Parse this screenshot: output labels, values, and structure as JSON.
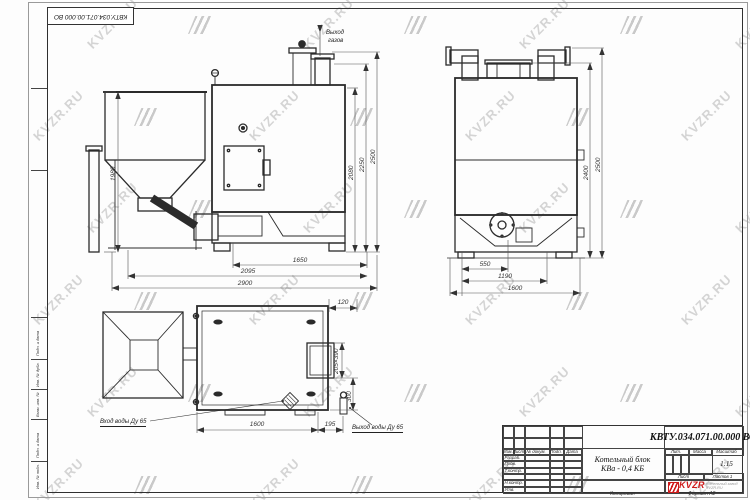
{
  "watermark": {
    "text": "KVZR.RU"
  },
  "frame": {
    "corner_stamp": "КВТУ.034.071.00.000 ВО",
    "margin_labels": [
      "Подп. и дата",
      "Инв. № дубл.",
      "Взам. инв. №",
      "Подп. и дата",
      "Инв. № подл."
    ],
    "copied_label": "Копировал",
    "format_label": "Формат А2"
  },
  "labels": {
    "gas_out_line1": "Выход",
    "gas_out_line2": "газов",
    "water_in": "Вход воды Ду 65",
    "water_out": "Выход воды Ду 65"
  },
  "dims": {
    "front_hopper_height": "1980",
    "front_h1": "2080",
    "front_h2": "2250",
    "front_h3": "2500",
    "front_w1": "1650",
    "front_w2": "2095",
    "front_w3": "2900",
    "side_h1": "2400",
    "side_h2": "2500",
    "side_w1": "550",
    "side_w2": "1190",
    "side_w3": "1600",
    "plan_offset": "120",
    "plan_window": "205×390",
    "plan_depth": "300",
    "plan_w1": "1600",
    "plan_w2": "195"
  },
  "title_block": {
    "doc_number": "КВТУ.034.071.00.000 ВО",
    "name_line1": "Котельный блок",
    "name_line2": "КВа - 0,4 КБ",
    "header_cols": [
      "Изм.",
      "Лист",
      "№ докум.",
      "Подп.",
      "Дата"
    ],
    "rows": [
      "Разраб.",
      "Пров.",
      "Т.контр.",
      "Н.контр.",
      "Утв."
    ],
    "lit_label": "Лит.",
    "mass_label": "Масса",
    "scale_label": "Масштаб",
    "scale_value": "1:15",
    "sheet_label": "Лист",
    "sheets_label": "Листов 1",
    "logo_text": "KVZR",
    "org_line1": "Котельный завод",
    "org_line2": "KVZR.RU"
  },
  "colors": {
    "logo_red": "#cf1b1b",
    "line": "#2b2b2b",
    "watermark": "#bcbcbc"
  }
}
